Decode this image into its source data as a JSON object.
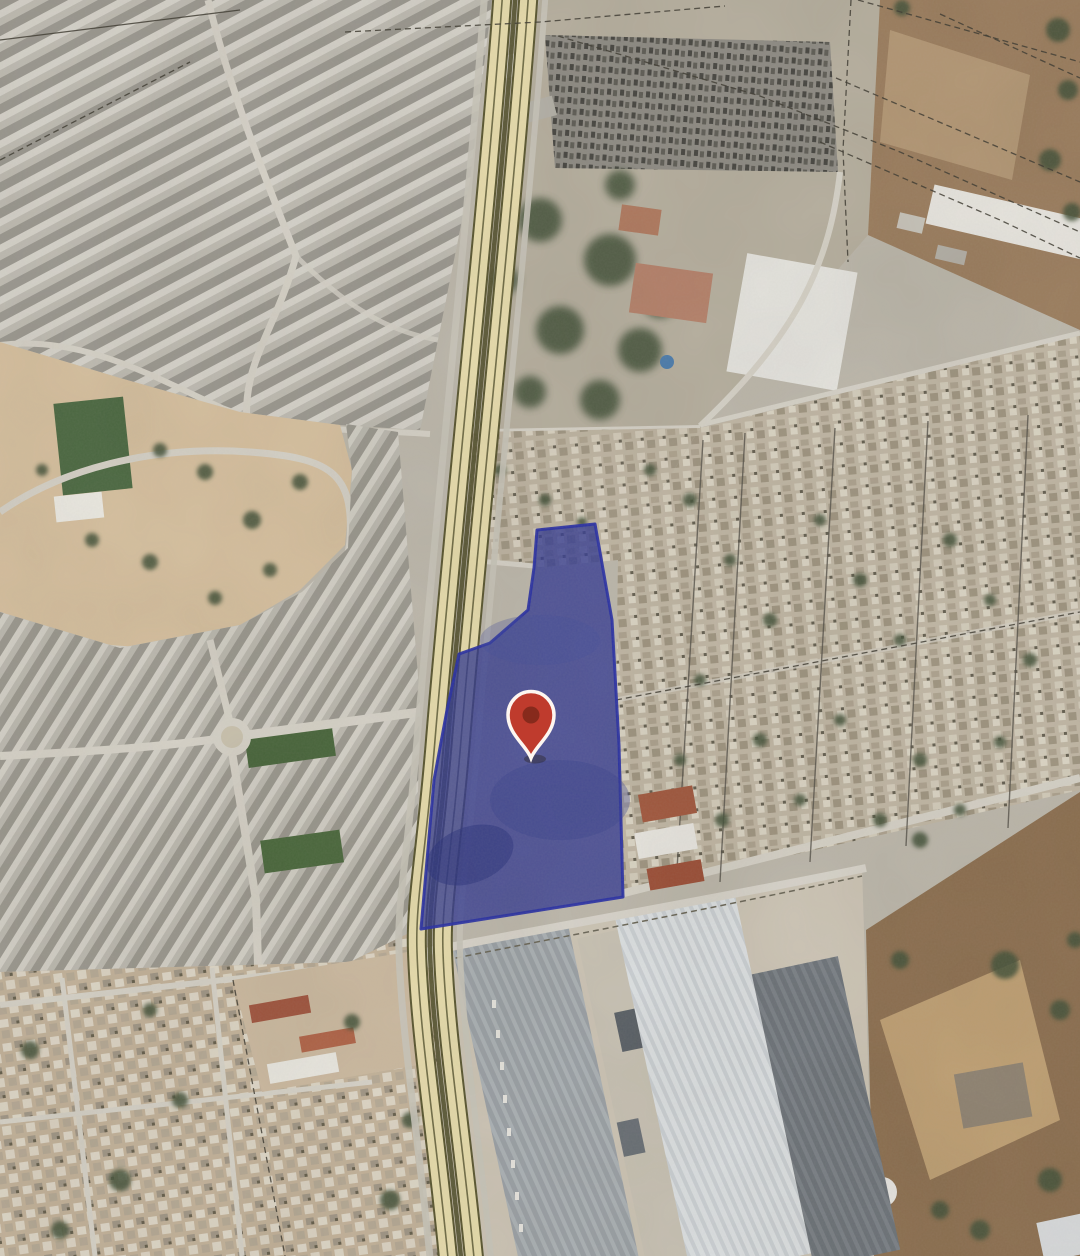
{
  "map": {
    "kind": "satellite-imagery-with-overlay",
    "visible_text": "none",
    "colors": {
      "parcel-fill": "#333b93",
      "parcel-opacity": "0.78",
      "parcel-stroke": "#2a31a6",
      "pin-fill": "#bf3b2d",
      "pin-inner": "#872a1c",
      "pin-outline": "#fdf6f0",
      "hwy-fill": "#e8ddad",
      "hwy-casing": "#5a5731",
      "hwy-median": "#53512d"
    },
    "overlay": {
      "parcel": {
        "label": "highlighted-land-parcel",
        "points": "537,530 595,524 612,620 619,745 623,897 421,929 434,780 447,710 459,654 490,643 528,610 534,568"
      },
      "marker": {
        "label": "location-pin",
        "x": 531,
        "y": 758,
        "transform": "translate(531,758)"
      },
      "highway": {
        "label": "divided-highway",
        "path": "M516,-12 C502,190 468,500 448,740 C439,852 428,902 430,952 C433,1040 450,1140 462,1268"
      }
    }
  }
}
